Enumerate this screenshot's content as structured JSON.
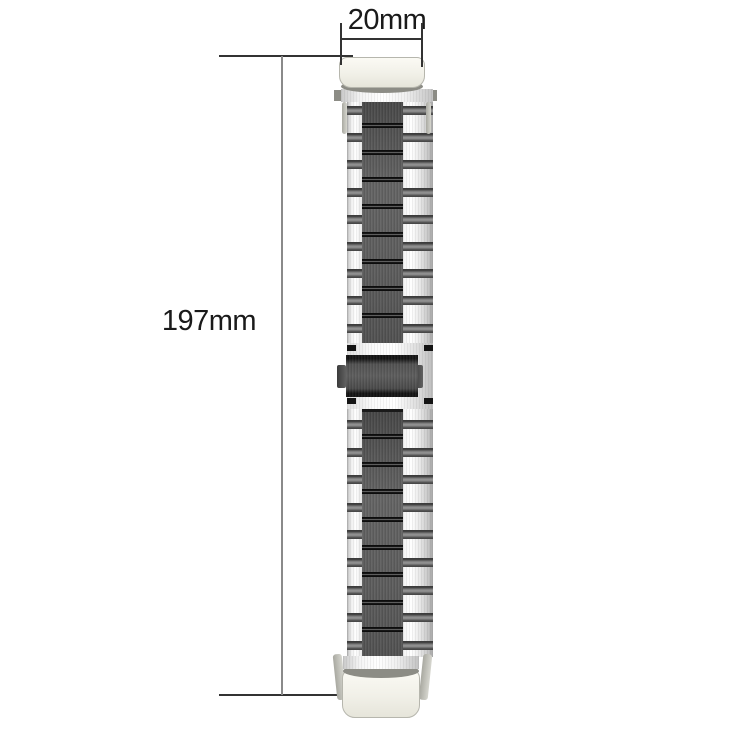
{
  "page": {
    "background": "#ffffff"
  },
  "dimensions": {
    "width": {
      "label": "20mm"
    },
    "length": {
      "label": "197mm"
    }
  },
  "band": {
    "links_above_clasp": 9,
    "links_below_clasp": 9
  },
  "colors": {
    "page_bg": "#ffffff",
    "label_text": "#1a1a1a",
    "tick_line": "#333333",
    "extent_line": "#8a8a8a",
    "spacer": "#8f8f8f",
    "separator": "#0d0d0d",
    "clasp_edge": "#141414",
    "lug_cream": "#f1f0e8",
    "lug_edge": "#b6b6ad",
    "curve_shadow": "#8c8c85"
  }
}
